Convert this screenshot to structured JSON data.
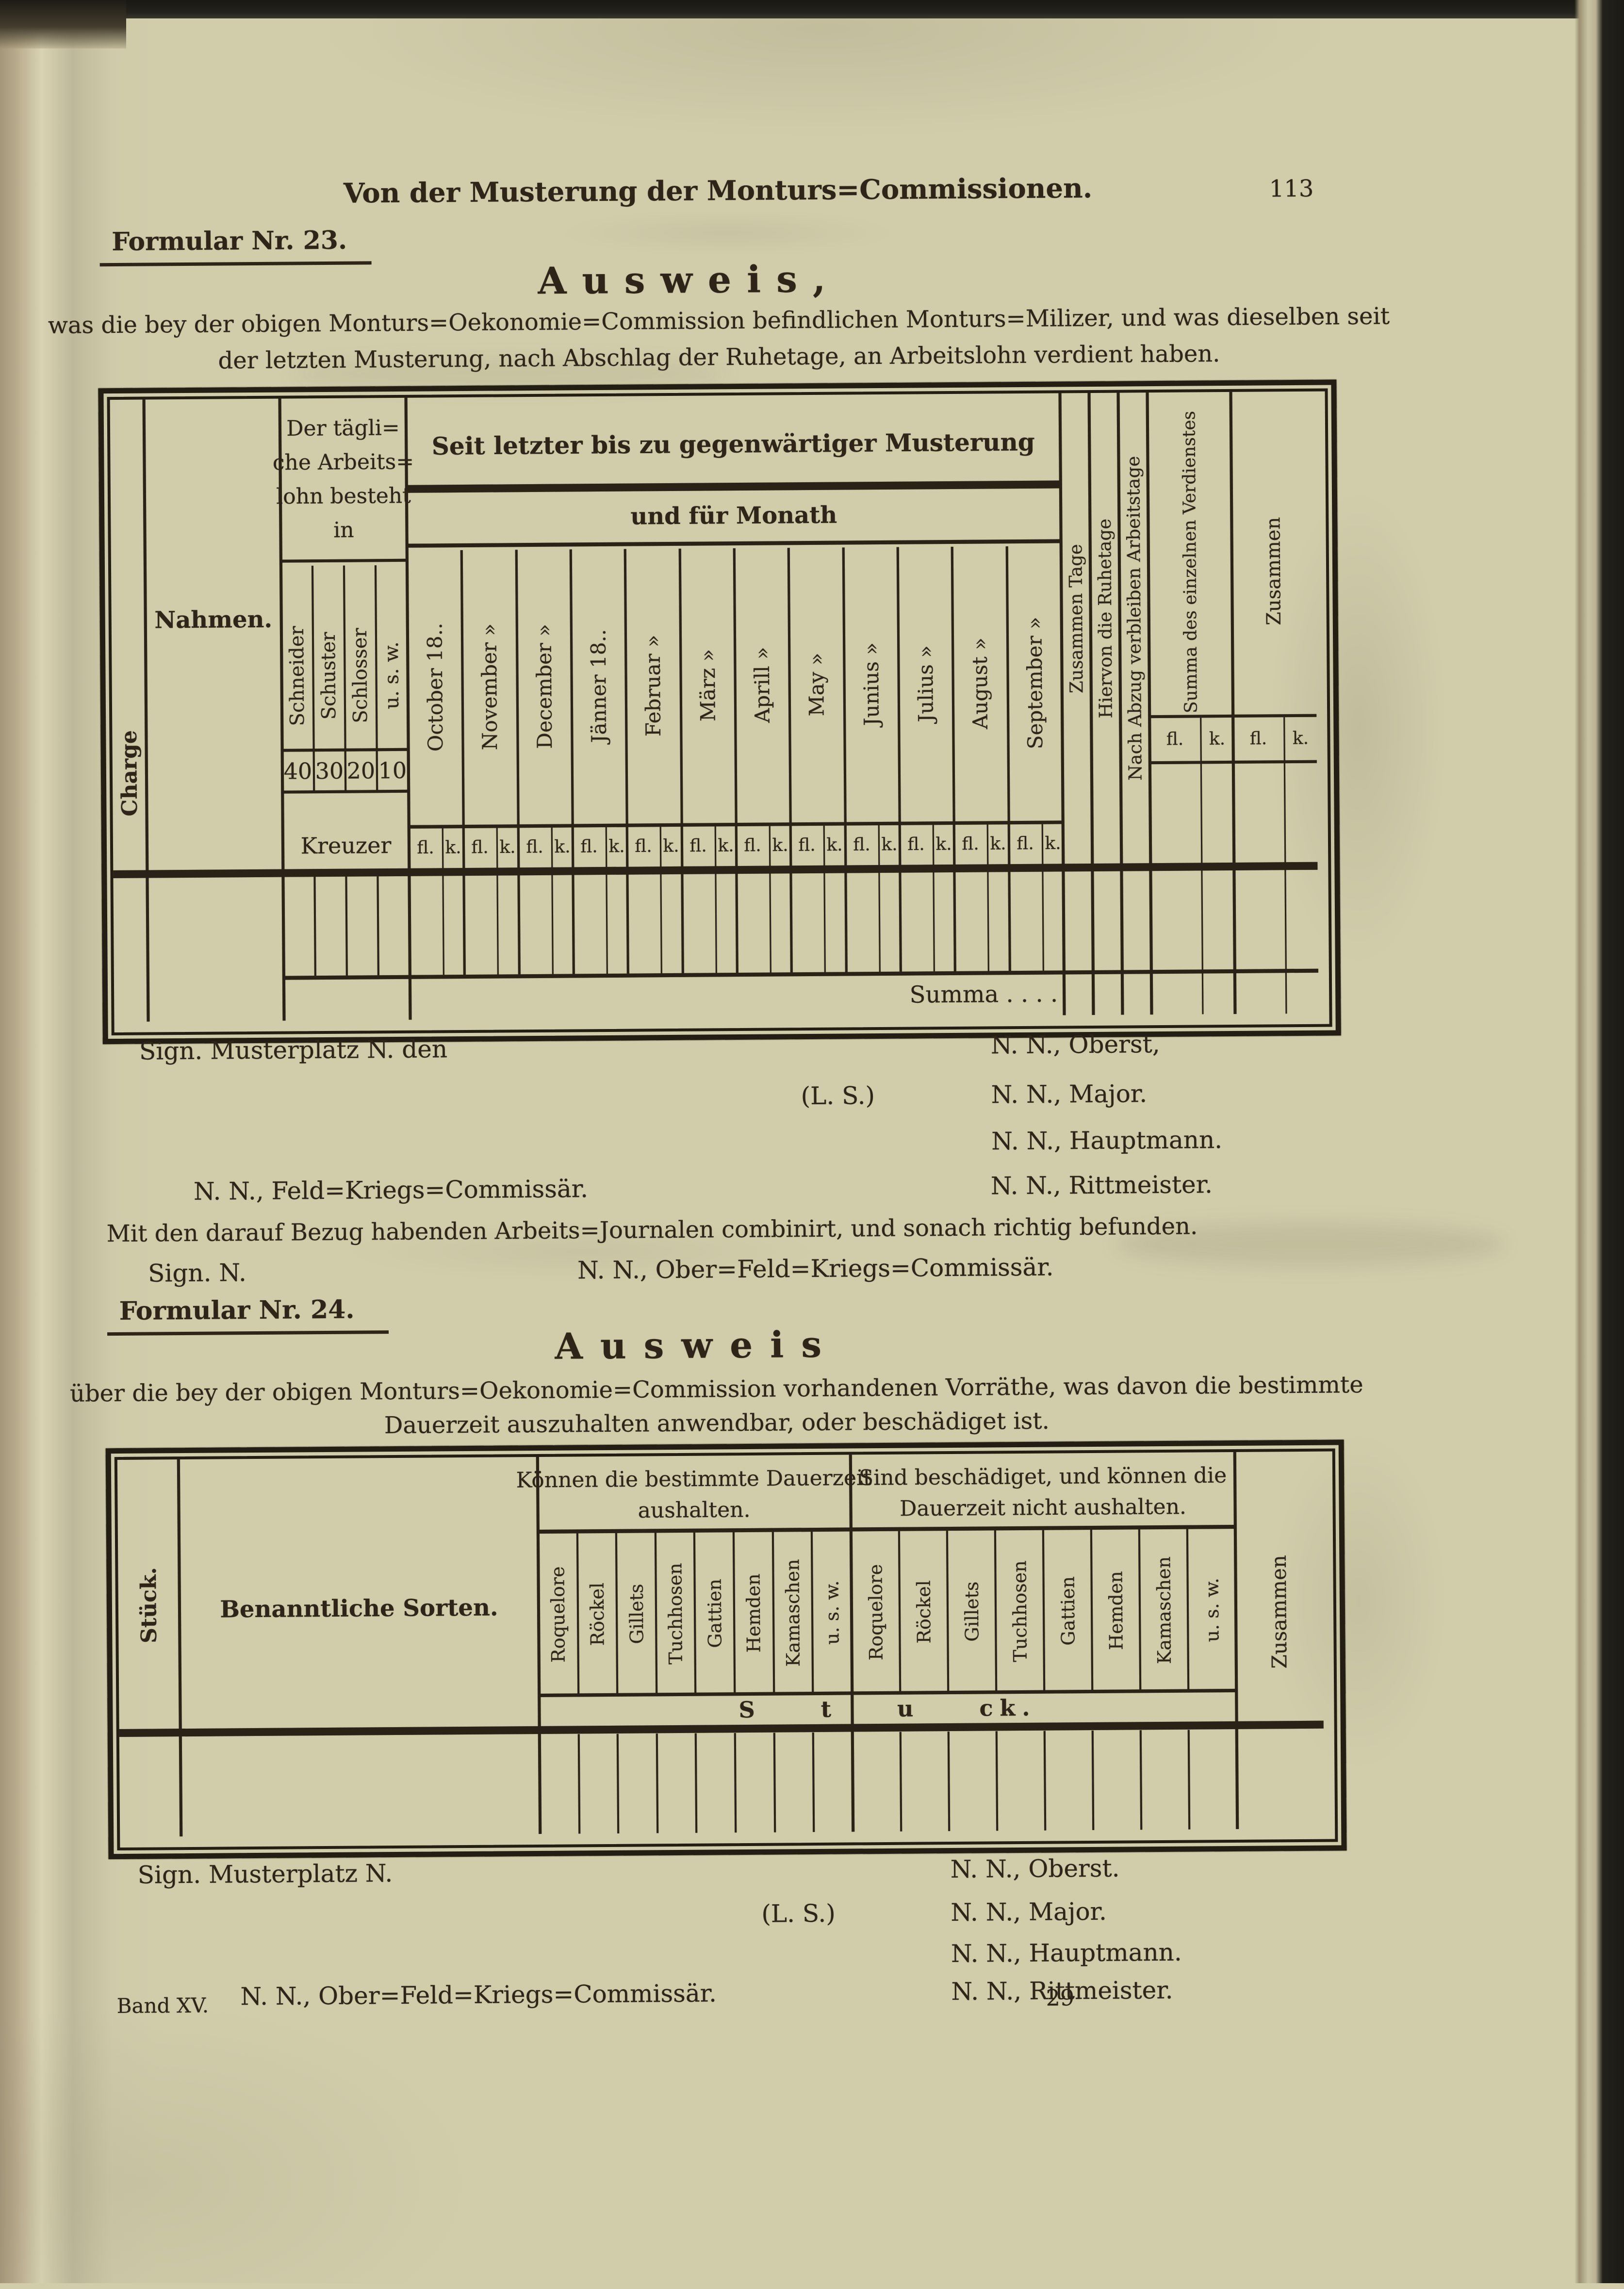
{
  "page": {
    "running_head": "Von der Musterung der Monturs=Commissionen.",
    "page_number": "113",
    "footer": {
      "volume": "Band XV.",
      "sheet": "29"
    }
  },
  "formular23": {
    "label": "Formular Nr. 23.",
    "title": "Ausweis,",
    "intro": [
      "was die bey der obigen Monturs=Oekonomie=Commission befindlichen Monturs=Milizer, und was dieselben seit",
      "der letzten Musterung, nach Abschlag der Ruhetage, an Arbeitslohn verdient haben."
    ],
    "table": {
      "charge_col": "Charge",
      "nahmen_col": "Nahmen.",
      "wage_group": {
        "header_lines": [
          "Der tägli=",
          "che Arbeits=",
          "lohn besteht",
          "in"
        ],
        "trades": [
          "Schneider",
          "Schuster",
          "Schlosser",
          "u. s. w."
        ],
        "rates": [
          "40",
          "30",
          "20",
          "10"
        ],
        "unit": "Kreuzer"
      },
      "period_group": {
        "header": "Seit letzter bis zu gegenwärtiger Musterung",
        "subheader": "und für Monath",
        "months": [
          "October 18..",
          "November »",
          "December »",
          "Jänner 18..",
          "Februar »",
          "März »",
          "Aprill »",
          "May »",
          "Junius »",
          "Julius »",
          "August »",
          "September »"
        ],
        "gulden": "fl.",
        "kreuzer": "k."
      },
      "tage_cols": [
        "Zusammen Tage",
        "Hiervon die Ruhetage",
        "Nach Abzug verbleiben Arbeitstage"
      ],
      "summa_col": "Summa des einzelnen Verdienstes",
      "zusammen_col": "Zusammen",
      "summa_row": "Summa . . . ."
    },
    "signature": {
      "place": "Sign. Musterplatz N. den",
      "seal": "(L. S.)",
      "right": [
        "N. N., Oberst,",
        "N. N., Major.",
        "N. N., Hauptmann.",
        "N. N., Rittmeister."
      ],
      "left": "N. N., Feld=Kriegs=Commissär.",
      "note": "Mit den darauf Bezug habenden Arbeits=Journalen combinirt, und sonach richtig befunden.",
      "sign_short": "Sign. N.",
      "ober": "N. N., Ober=Feld=Kriegs=Commissär."
    }
  },
  "formular24": {
    "label": "Formular Nr. 24.",
    "title": "Ausweis",
    "intro": [
      "über die bey der obigen Monturs=Oekonomie=Commission vorhandenen Vorräthe, was davon die bestimmte",
      "Dauerzeit auszuhalten anwendbar, oder beschädiget ist."
    ],
    "table": {
      "stueck_col": "Stück.",
      "sorten_col": "Benanntliche Sorten.",
      "group_good": {
        "header_lines": [
          "Können die bestimmte Dauerzeit",
          "aushalten."
        ]
      },
      "group_bad": {
        "header_lines": [
          "Sind beschädiget, und können die",
          "Dauerzeit nicht aushalten."
        ]
      },
      "sorten": [
        "Roquelore",
        "Röckel",
        "Gillets",
        "Tuchhosen",
        "Gattien",
        "Hemden",
        "Kamaschen",
        "u. s. w."
      ],
      "zusammen_col": "Zusammen",
      "unit_row": "S t u ck."
    },
    "signature": {
      "place": "Sign. Musterplatz N.",
      "seal": "(L. S.)",
      "right": [
        "N. N., Oberst.",
        "N. N., Major.",
        "N. N., Hauptmann.",
        "N. N., Rittmeister."
      ],
      "left": "N. N., Ober=Feld=Kriegs=Commissär."
    }
  }
}
